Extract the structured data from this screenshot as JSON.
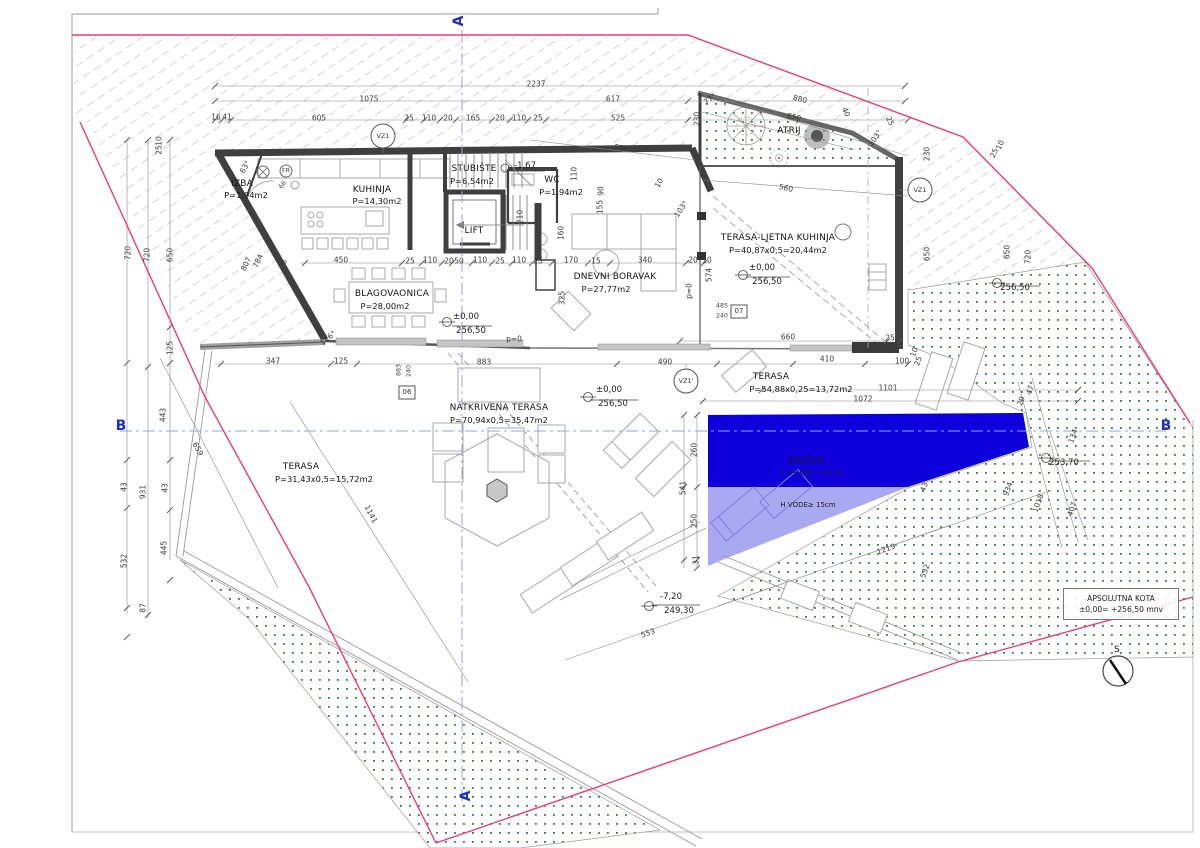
{
  "drawing": {
    "type": "architectural site / floor plan",
    "language": "hr",
    "level": "ground floor with pool"
  },
  "colors": {
    "property_line": "#ee3a78",
    "pool_deep": "#0d00dd",
    "pool_shallow": "#a9a9f2",
    "section_marker": "#1d32b5",
    "green_dot": "#39793a",
    "wall": "#3f3f3f",
    "hatch": "#d9d7de"
  },
  "kota": {
    "line1": "APSOLUTNA KOTA",
    "line2": "±0,00= +256,50 mnv"
  },
  "labels": [
    {
      "t": "A",
      "x": 459,
      "y": 21,
      "r": -90,
      "c": "sec",
      "n": "section-marker-a-top"
    },
    {
      "t": "A",
      "x": 466,
      "y": 796,
      "r": -90,
      "c": "sec",
      "n": "section-marker-a-bottom"
    },
    {
      "t": "B",
      "x": 121,
      "y": 426,
      "c": "sec",
      "n": "section-marker-b-left"
    },
    {
      "t": "B",
      "x": 1166,
      "y": 426,
      "c": "sec",
      "n": "section-marker-b-right"
    },
    {
      "t": "IZBA",
      "x": 242,
      "y": 184,
      "c": "room",
      "n": "room-label-izba"
    },
    {
      "t": "P=1,94m2",
      "x": 246,
      "y": 195,
      "c": "area",
      "n": "room-area-izba"
    },
    {
      "t": "KUHINJA",
      "x": 372,
      "y": 190,
      "c": "room",
      "n": "room-label-kuhinja"
    },
    {
      "t": "P=14,30m2",
      "x": 377,
      "y": 201,
      "c": "area",
      "n": "room-area-kuhinja"
    },
    {
      "t": "STUBIŠTE",
      "x": 474,
      "y": 169,
      "c": "room",
      "n": "room-label-stubiste"
    },
    {
      "t": "P=6,54m2",
      "x": 472,
      "y": 181,
      "c": "area",
      "n": "room-area-stubiste"
    },
    {
      "t": "WC",
      "x": 552,
      "y": 180,
      "c": "room",
      "n": "room-label-wc"
    },
    {
      "t": "P=1,94m2",
      "x": 561,
      "y": 192,
      "c": "area",
      "n": "room-area-wc"
    },
    {
      "t": "LIFT",
      "x": 474,
      "y": 231,
      "c": "room",
      "n": "room-label-lift"
    },
    {
      "t": "BLAGOVAONICA",
      "x": 392,
      "y": 294,
      "c": "room",
      "n": "room-label-blagovaonica"
    },
    {
      "t": "P=28,00m2",
      "x": 385,
      "y": 306,
      "c": "area",
      "n": "room-area-blagovaonica"
    },
    {
      "t": "DNEVNI BORAVAK",
      "x": 615,
      "y": 277,
      "c": "room",
      "n": "room-label-dnevni-boravak"
    },
    {
      "t": "P=27,77m2",
      "x": 606,
      "y": 289,
      "c": "area",
      "n": "room-area-dnevni-boravak"
    },
    {
      "t": "TERASA-LJETNA KUHINJA",
      "x": 778,
      "y": 238,
      "c": "room",
      "n": "room-label-terasa-ljetna-kuhinja"
    },
    {
      "t": "P=40,87x0,5=20,44m2",
      "x": 778,
      "y": 250,
      "c": "area",
      "n": "room-area-terasa-ljetna-kuhinja"
    },
    {
      "t": "ATRIJ",
      "x": 789,
      "y": 131,
      "c": "room",
      "n": "room-label-atrij"
    },
    {
      "t": "NATKRIVENA TERASA",
      "x": 499,
      "y": 408,
      "c": "room",
      "n": "room-label-natkrivena-terasa"
    },
    {
      "t": "P=70,94x0,5=35,47m2",
      "x": 499,
      "y": 420,
      "c": "area",
      "n": "room-area-natkrivena-terasa"
    },
    {
      "t": "TERASA",
      "x": 301,
      "y": 467,
      "c": "room",
      "n": "room-label-terasa-west"
    },
    {
      "t": "P=31,43x0,5=15,72m2",
      "x": 324,
      "y": 479,
      "c": "area",
      "n": "room-area-terasa-west"
    },
    {
      "t": "TERASA",
      "x": 771,
      "y": 377,
      "c": "room",
      "n": "room-label-terasa-pool"
    },
    {
      "t": "P=54,88x0,25=13,72m2",
      "x": 801,
      "y": 389,
      "c": "area",
      "n": "room-area-terasa-pool"
    },
    {
      "t": "BAZEN",
      "x": 806,
      "y": 461,
      "c": "pool",
      "n": "pool-label"
    },
    {
      "t": "H VODE= 150cm",
      "x": 812,
      "y": 473,
      "c": "pool2",
      "n": "pool-depth-label"
    },
    {
      "t": "H VODE≥ 15cm",
      "x": 808,
      "y": 505,
      "c": "h2o",
      "n": "pool-shallow-label"
    },
    {
      "t": "S",
      "x": 1117,
      "y": 650,
      "c": "room",
      "n": "north-label"
    },
    {
      "t": "±0,00",
      "x": 466,
      "y": 317,
      "c": "elev",
      "n": "elevation-value"
    },
    {
      "t": "256,50",
      "x": 471,
      "y": 331,
      "c": "elev",
      "n": "elevation-value"
    },
    {
      "t": "±0,00",
      "x": 609,
      "y": 390,
      "c": "elev",
      "n": "elevation-value"
    },
    {
      "t": "256,50",
      "x": 613,
      "y": 404,
      "c": "elev",
      "n": "elevation-value"
    },
    {
      "t": "±0,00",
      "x": 762,
      "y": 268,
      "c": "elev",
      "n": "elevation-value"
    },
    {
      "t": "256,50",
      "x": 767,
      "y": 282,
      "c": "elev",
      "n": "elevation-value"
    },
    {
      "t": "256,50",
      "x": 1015,
      "y": 288,
      "c": "elev",
      "n": "elevation-value"
    },
    {
      "t": "-7,20",
      "x": 671,
      "y": 597,
      "c": "elev",
      "n": "elevation-value"
    },
    {
      "t": "249,30",
      "x": 679,
      "y": 611,
      "c": "elev",
      "n": "elevation-value"
    },
    {
      "t": "253,70",
      "x": 1064,
      "y": 463,
      "c": "elev",
      "n": "elevation-value"
    },
    {
      "t": "-1,67",
      "x": 525,
      "y": 166,
      "c": "elev",
      "n": "elevation-value"
    },
    {
      "t": "VZ1",
      "x": 383,
      "y": 136,
      "c": "vz",
      "n": "vz1-marker-label"
    },
    {
      "t": "VZ1",
      "x": 920,
      "y": 190,
      "c": "vz",
      "n": "vz1-marker-label"
    },
    {
      "t": "VZ1'",
      "x": 686,
      "y": 381,
      "c": "vz",
      "n": "vz1-prime-marker-label"
    },
    {
      "t": "06",
      "x": 407,
      "y": 392,
      "c": "boxlbl",
      "n": "detail-box-06"
    },
    {
      "t": "07",
      "x": 739,
      "y": 311,
      "c": "boxlbl",
      "n": "detail-box-07"
    },
    {
      "t": "883",
      "x": 399,
      "y": 370,
      "r": -90,
      "c": "tiny",
      "n": "dimension-label"
    },
    {
      "t": "240",
      "x": 409,
      "y": 371,
      "r": -90,
      "c": "tiny",
      "n": "dimension-label"
    },
    {
      "t": "485",
      "x": 722,
      "y": 306,
      "c": "tiny",
      "n": "dimension-label"
    },
    {
      "t": "240",
      "x": 722,
      "y": 316,
      "c": "tiny",
      "n": "dimension-label"
    },
    {
      "t": "FR",
      "x": 286,
      "y": 171,
      "c": "tiny",
      "n": "appliance-label"
    },
    {
      "t": "66",
      "x": 283,
      "y": 185,
      "r": -55,
      "c": "tiny",
      "n": "dimension-label"
    },
    {
      "t": "2237",
      "x": 536,
      "y": 84,
      "c": "dim",
      "n": "dimension-label"
    },
    {
      "t": "1075",
      "x": 369,
      "y": 99,
      "c": "dim",
      "n": "dimension-label"
    },
    {
      "t": "617",
      "x": 613,
      "y": 99,
      "c": "dim",
      "n": "dimension-label"
    },
    {
      "t": "880",
      "x": 800,
      "y": 99,
      "r": 14,
      "c": "dim",
      "n": "dimension-label"
    },
    {
      "t": "16",
      "x": 216,
      "y": 117,
      "c": "dim",
      "n": "dimension-label"
    },
    {
      "t": "41",
      "x": 227,
      "y": 117,
      "c": "dim",
      "n": "dimension-label"
    },
    {
      "t": "605",
      "x": 319,
      "y": 118,
      "c": "dim",
      "n": "dimension-label"
    },
    {
      "t": "25",
      "x": 409,
      "y": 118,
      "c": "dim",
      "n": "dimension-label"
    },
    {
      "t": "110",
      "x": 429,
      "y": 118,
      "c": "dim",
      "n": "dimension-label"
    },
    {
      "t": "20",
      "x": 448,
      "y": 118,
      "c": "dim",
      "n": "dimension-label"
    },
    {
      "t": "165",
      "x": 473,
      "y": 118,
      "c": "dim",
      "n": "dimension-label"
    },
    {
      "t": "20",
      "x": 500,
      "y": 118,
      "c": "dim",
      "n": "dimension-label"
    },
    {
      "t": "110",
      "x": 519,
      "y": 118,
      "c": "dim",
      "n": "dimension-label"
    },
    {
      "t": "25",
      "x": 538,
      "y": 118,
      "c": "dim",
      "n": "dimension-label"
    },
    {
      "t": "525",
      "x": 618,
      "y": 118,
      "c": "dim",
      "n": "dimension-label"
    },
    {
      "t": "230",
      "x": 697,
      "y": 119,
      "r": -90,
      "c": "dim",
      "n": "dimension-label"
    },
    {
      "t": "650",
      "x": 794,
      "y": 117,
      "r": 14,
      "c": "dim",
      "n": "dimension-label"
    },
    {
      "t": "40",
      "x": 846,
      "y": 112,
      "r": 65,
      "c": "dim",
      "n": "dimension-label"
    },
    {
      "t": "25",
      "x": 890,
      "y": 121,
      "r": 65,
      "c": "dim",
      "n": "dimension-label"
    },
    {
      "t": "77°",
      "x": 710,
      "y": 99,
      "r": -35,
      "c": "dim",
      "n": "angle-label"
    },
    {
      "t": "103°",
      "x": 875,
      "y": 138,
      "r": -55,
      "c": "dim",
      "n": "angle-label"
    },
    {
      "t": "634",
      "x": 621,
      "y": 148,
      "r": 13,
      "c": "dim",
      "n": "dimension-label"
    },
    {
      "t": "10",
      "x": 659,
      "y": 183,
      "r": -60,
      "c": "dim",
      "n": "dimension-label"
    },
    {
      "t": "560",
      "x": 786,
      "y": 188,
      "r": 13,
      "c": "dim",
      "n": "dimension-label"
    },
    {
      "t": "25",
      "x": 994,
      "y": 153,
      "r": -65,
      "c": "dim",
      "n": "dimension-label"
    },
    {
      "t": "10",
      "x": 1000,
      "y": 145,
      "r": -65,
      "c": "dim",
      "n": "dimension-label"
    },
    {
      "t": "25",
      "x": 159,
      "y": 150,
      "r": -90,
      "c": "dim",
      "n": "dimension-label"
    },
    {
      "t": "10",
      "x": 159,
      "y": 141,
      "r": -90,
      "c": "dim",
      "n": "dimension-label"
    },
    {
      "t": "720",
      "x": 128,
      "y": 253,
      "r": -90,
      "c": "dim",
      "n": "dimension-label"
    },
    {
      "t": "720",
      "x": 147,
      "y": 255,
      "r": -90,
      "c": "dim",
      "n": "dimension-label"
    },
    {
      "t": "650",
      "x": 170,
      "y": 255,
      "r": -90,
      "c": "dim",
      "n": "dimension-label"
    },
    {
      "t": "807",
      "x": 246,
      "y": 264,
      "r": -65,
      "c": "dim",
      "n": "dimension-label"
    },
    {
      "t": "784",
      "x": 258,
      "y": 261,
      "r": -65,
      "c": "dim",
      "n": "dimension-label"
    },
    {
      "t": "25",
      "x": 283,
      "y": 264,
      "r": -65,
      "c": "dim",
      "n": "dimension-label"
    },
    {
      "t": "63°",
      "x": 245,
      "y": 167,
      "r": -60,
      "c": "dim",
      "n": "angle-label"
    },
    {
      "t": "125",
      "x": 170,
      "y": 348,
      "r": -90,
      "c": "dim",
      "n": "dimension-label"
    },
    {
      "t": "443",
      "x": 163,
      "y": 415,
      "r": -90,
      "c": "dim",
      "n": "dimension-label"
    },
    {
      "t": "43",
      "x": 124,
      "y": 487,
      "r": -90,
      "c": "dim",
      "n": "dimension-label"
    },
    {
      "t": "931",
      "x": 143,
      "y": 492,
      "r": -90,
      "c": "dim",
      "n": "dimension-label"
    },
    {
      "t": "43",
      "x": 165,
      "y": 488,
      "r": -90,
      "c": "dim",
      "n": "dimension-label"
    },
    {
      "t": "532",
      "x": 124,
      "y": 561,
      "r": -90,
      "c": "dim",
      "n": "dimension-label"
    },
    {
      "t": "445",
      "x": 164,
      "y": 548,
      "r": -90,
      "c": "dim",
      "n": "dimension-label"
    },
    {
      "t": "87",
      "x": 143,
      "y": 608,
      "r": -90,
      "c": "dim",
      "n": "dimension-label"
    },
    {
      "t": "450",
      "x": 341,
      "y": 260,
      "c": "dim",
      "n": "dimension-label"
    },
    {
      "t": "25",
      "x": 410,
      "y": 261,
      "c": "dim",
      "n": "dimension-label"
    },
    {
      "t": "110",
      "x": 430,
      "y": 260,
      "c": "dim",
      "n": "dimension-label"
    },
    {
      "t": "20",
      "x": 449,
      "y": 261,
      "c": "dim",
      "n": "dimension-label"
    },
    {
      "t": "50",
      "x": 459,
      "y": 261,
      "c": "dim",
      "n": "dimension-label"
    },
    {
      "t": "110",
      "x": 480,
      "y": 260,
      "c": "dim",
      "n": "dimension-label"
    },
    {
      "t": "25",
      "x": 500,
      "y": 261,
      "c": "dim",
      "n": "dimension-label"
    },
    {
      "t": "110",
      "x": 519,
      "y": 260,
      "c": "dim",
      "n": "dimension-label"
    },
    {
      "t": "25",
      "x": 538,
      "y": 261,
      "c": "dim",
      "n": "dimension-label"
    },
    {
      "t": "170",
      "x": 571,
      "y": 260,
      "c": "dim",
      "n": "dimension-label"
    },
    {
      "t": "15",
      "x": 596,
      "y": 261,
      "c": "dim",
      "n": "dimension-label"
    },
    {
      "t": "340",
      "x": 645,
      "y": 260,
      "c": "dim",
      "n": "dimension-label"
    },
    {
      "t": "20",
      "x": 693,
      "y": 260,
      "c": "dim",
      "n": "dimension-label"
    },
    {
      "t": "10",
      "x": 707,
      "y": 260,
      "c": "dim",
      "n": "dimension-label"
    },
    {
      "t": "110",
      "x": 574,
      "y": 174,
      "r": -90,
      "c": "dim",
      "n": "dimension-label"
    },
    {
      "t": "210",
      "x": 520,
      "y": 217,
      "r": -90,
      "c": "dim",
      "n": "dimension-label"
    },
    {
      "t": "90",
      "x": 601,
      "y": 191,
      "r": -90,
      "c": "dim",
      "n": "dimension-label"
    },
    {
      "t": "155",
      "x": 600,
      "y": 207,
      "r": -90,
      "c": "dim",
      "n": "dimension-label"
    },
    {
      "t": "160",
      "x": 561,
      "y": 233,
      "r": -90,
      "c": "dim",
      "n": "dimension-label"
    },
    {
      "t": "325",
      "x": 562,
      "y": 298,
      "r": -90,
      "c": "dim",
      "n": "dimension-label"
    },
    {
      "t": "574",
      "x": 709,
      "y": 275,
      "r": -90,
      "c": "dim",
      "n": "dimension-label"
    },
    {
      "t": "p=0",
      "x": 689,
      "y": 291,
      "r": -90,
      "c": "dim",
      "n": "dimension-label"
    },
    {
      "t": "p=0",
      "x": 514,
      "y": 339,
      "c": "dim",
      "n": "dimension-label"
    },
    {
      "t": "116°",
      "x": 328,
      "y": 338,
      "r": -40,
      "c": "dim",
      "n": "angle-label"
    },
    {
      "t": "103°",
      "x": 681,
      "y": 209,
      "r": -55,
      "c": "dim",
      "n": "angle-label"
    },
    {
      "t": "660",
      "x": 788,
      "y": 337,
      "c": "dim",
      "n": "dimension-label"
    },
    {
      "t": "25",
      "x": 890,
      "y": 338,
      "c": "dim",
      "n": "dimension-label"
    },
    {
      "t": "347",
      "x": 273,
      "y": 361,
      "c": "dim",
      "n": "dimension-label"
    },
    {
      "t": "125",
      "x": 341,
      "y": 361,
      "c": "dim",
      "n": "dimension-label"
    },
    {
      "t": "883",
      "x": 484,
      "y": 362,
      "c": "dim",
      "n": "dimension-label"
    },
    {
      "t": "490",
      "x": 665,
      "y": 362,
      "c": "dim",
      "n": "dimension-label"
    },
    {
      "t": "410",
      "x": 827,
      "y": 359,
      "c": "dim",
      "n": "dimension-label"
    },
    {
      "t": "100",
      "x": 902,
      "y": 361,
      "c": "dim",
      "n": "dimension-label"
    },
    {
      "t": "1101",
      "x": 888,
      "y": 388,
      "c": "dim",
      "n": "dimension-label"
    },
    {
      "t": "1072",
      "x": 863,
      "y": 399,
      "c": "dim",
      "n": "dimension-label"
    },
    {
      "t": "260",
      "x": 694,
      "y": 450,
      "r": -90,
      "c": "dim",
      "n": "dimension-label"
    },
    {
      "t": "541",
      "x": 683,
      "y": 488,
      "r": -90,
      "c": "dim",
      "n": "dimension-label"
    },
    {
      "t": "250",
      "x": 694,
      "y": 521,
      "r": -90,
      "c": "dim",
      "n": "dimension-label"
    },
    {
      "t": "31",
      "x": 696,
      "y": 560,
      "r": -90,
      "c": "dim",
      "n": "dimension-label"
    },
    {
      "t": "43",
      "x": 924,
      "y": 487,
      "r": -70,
      "c": "dim",
      "n": "dimension-label"
    },
    {
      "t": "1219",
      "x": 886,
      "y": 549,
      "r": -19,
      "c": "dim",
      "n": "dimension-label"
    },
    {
      "t": "532",
      "x": 925,
      "y": 571,
      "r": -70,
      "c": "dim",
      "n": "dimension-label"
    },
    {
      "t": "553",
      "x": 648,
      "y": 633,
      "r": -19,
      "c": "dim",
      "n": "dimension-label"
    },
    {
      "t": "230",
      "x": 927,
      "y": 154,
      "r": -90,
      "c": "dim",
      "n": "dimension-label"
    },
    {
      "t": "650",
      "x": 927,
      "y": 254,
      "r": -90,
      "c": "dim",
      "n": "dimension-label"
    },
    {
      "t": "650",
      "x": 1007,
      "y": 252,
      "r": -90,
      "c": "dim",
      "n": "dimension-label"
    },
    {
      "t": "720",
      "x": 1028,
      "y": 257,
      "r": -90,
      "c": "dim",
      "n": "dimension-label"
    },
    {
      "t": "47",
      "x": 1030,
      "y": 390,
      "r": -70,
      "c": "dim",
      "n": "dimension-label"
    },
    {
      "t": "29",
      "x": 1021,
      "y": 401,
      "r": -70,
      "c": "dim",
      "n": "dimension-label"
    },
    {
      "t": "134",
      "x": 1073,
      "y": 436,
      "r": -70,
      "c": "dim",
      "n": "dimension-label"
    },
    {
      "t": "934",
      "x": 1008,
      "y": 489,
      "r": -70,
      "c": "dim",
      "n": "dimension-label"
    },
    {
      "t": "1018",
      "x": 1038,
      "y": 503,
      "r": -70,
      "c": "dim",
      "n": "dimension-label"
    },
    {
      "t": "407",
      "x": 1072,
      "y": 509,
      "r": -70,
      "c": "dim",
      "n": "dimension-label"
    },
    {
      "t": "10",
      "x": 914,
      "y": 352,
      "r": -70,
      "c": "dim",
      "n": "dimension-label"
    },
    {
      "t": "25",
      "x": 918,
      "y": 361,
      "r": -70,
      "c": "dim",
      "n": "dimension-label"
    },
    {
      "t": "1141",
      "x": 371,
      "y": 514,
      "r": 62,
      "c": "dim",
      "n": "dimension-label"
    },
    {
      "t": "659",
      "x": 198,
      "y": 449,
      "r": 62,
      "c": "dim",
      "n": "dimension-label"
    }
  ]
}
